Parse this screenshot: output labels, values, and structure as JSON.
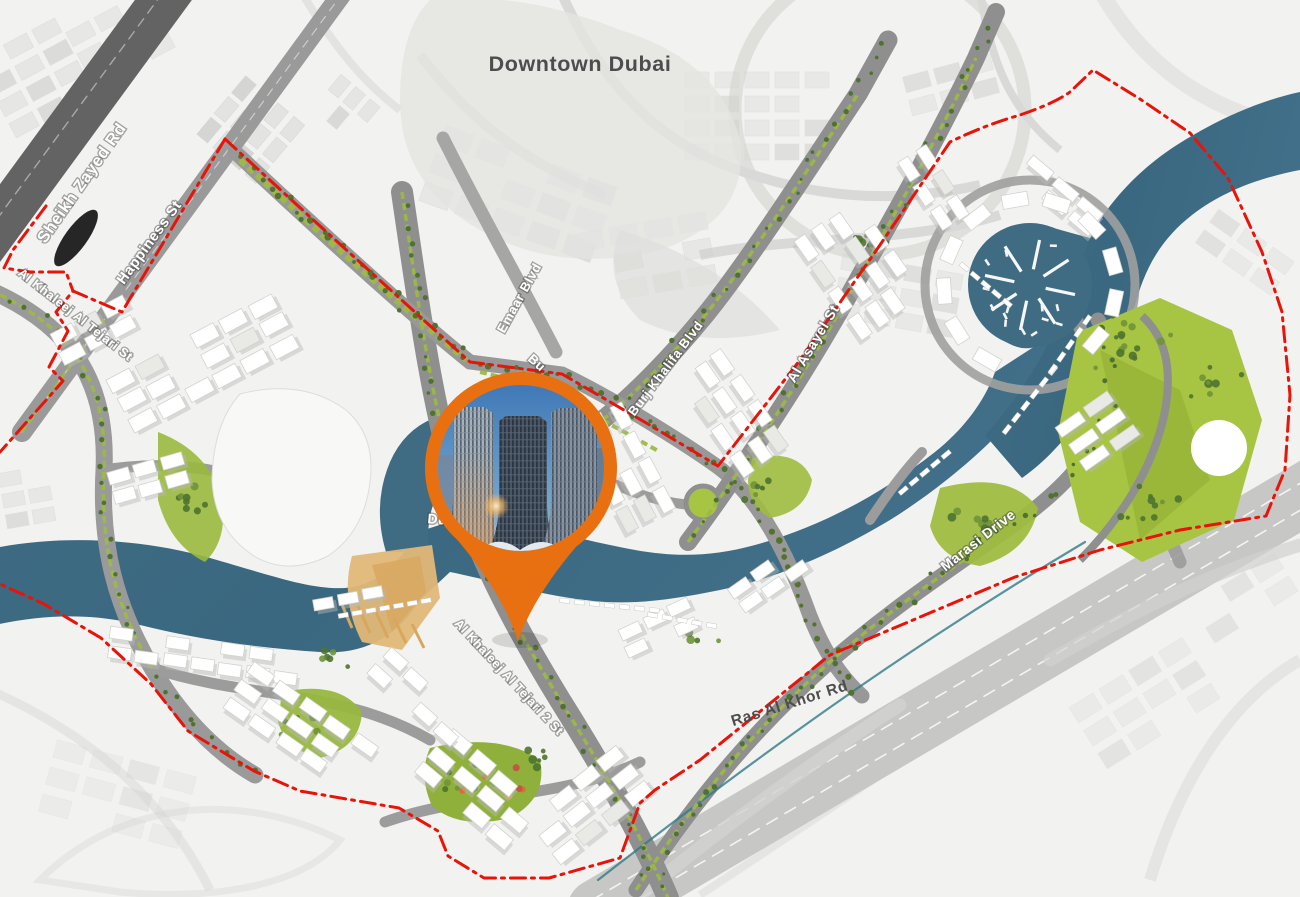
{
  "map": {
    "area_name": "Business Bay masterplan map",
    "labels": [
      {
        "id": "downtown-dubai",
        "text": "Downtown Dubai"
      },
      {
        "id": "sheikh-zayed-rd",
        "text": "Sheikh Zayed Rd"
      },
      {
        "id": "happiness-st",
        "text": "Happiness St"
      },
      {
        "id": "al-khaleej-al-tejari-st",
        "text": "Al Khaleej Al Tejari St"
      },
      {
        "id": "emaar-blvd",
        "text": "Emaar Blvd"
      },
      {
        "id": "burj-khalifa-blvd",
        "text": "Burj Khalifa Blvd"
      },
      {
        "id": "partial-bu",
        "text": "Bu"
      },
      {
        "id": "al-asayel-st",
        "text": "Al Asayel St"
      },
      {
        "id": "marasi-drive",
        "text": "Marasi Drive"
      },
      {
        "id": "ras-al-khor-rd",
        "text": "Ras Al Khor Rd"
      },
      {
        "id": "al-khaleej-al-tejari-2-st",
        "text": "Al Khaleej Al Tejari 2 St"
      },
      {
        "id": "partial-du",
        "text": "Du"
      }
    ],
    "colors": {
      "pin_orange": "#e97010",
      "boundary_red": "#e81309",
      "water_teal": "#3f6c83",
      "park_green": "#a8c443",
      "major_road": "#636363",
      "district_road": "#8f8f8f",
      "highway": "#c7c7c5",
      "label_dark": "#4d4d4d"
    },
    "pin": {
      "marks": "development location with towers photo"
    }
  }
}
